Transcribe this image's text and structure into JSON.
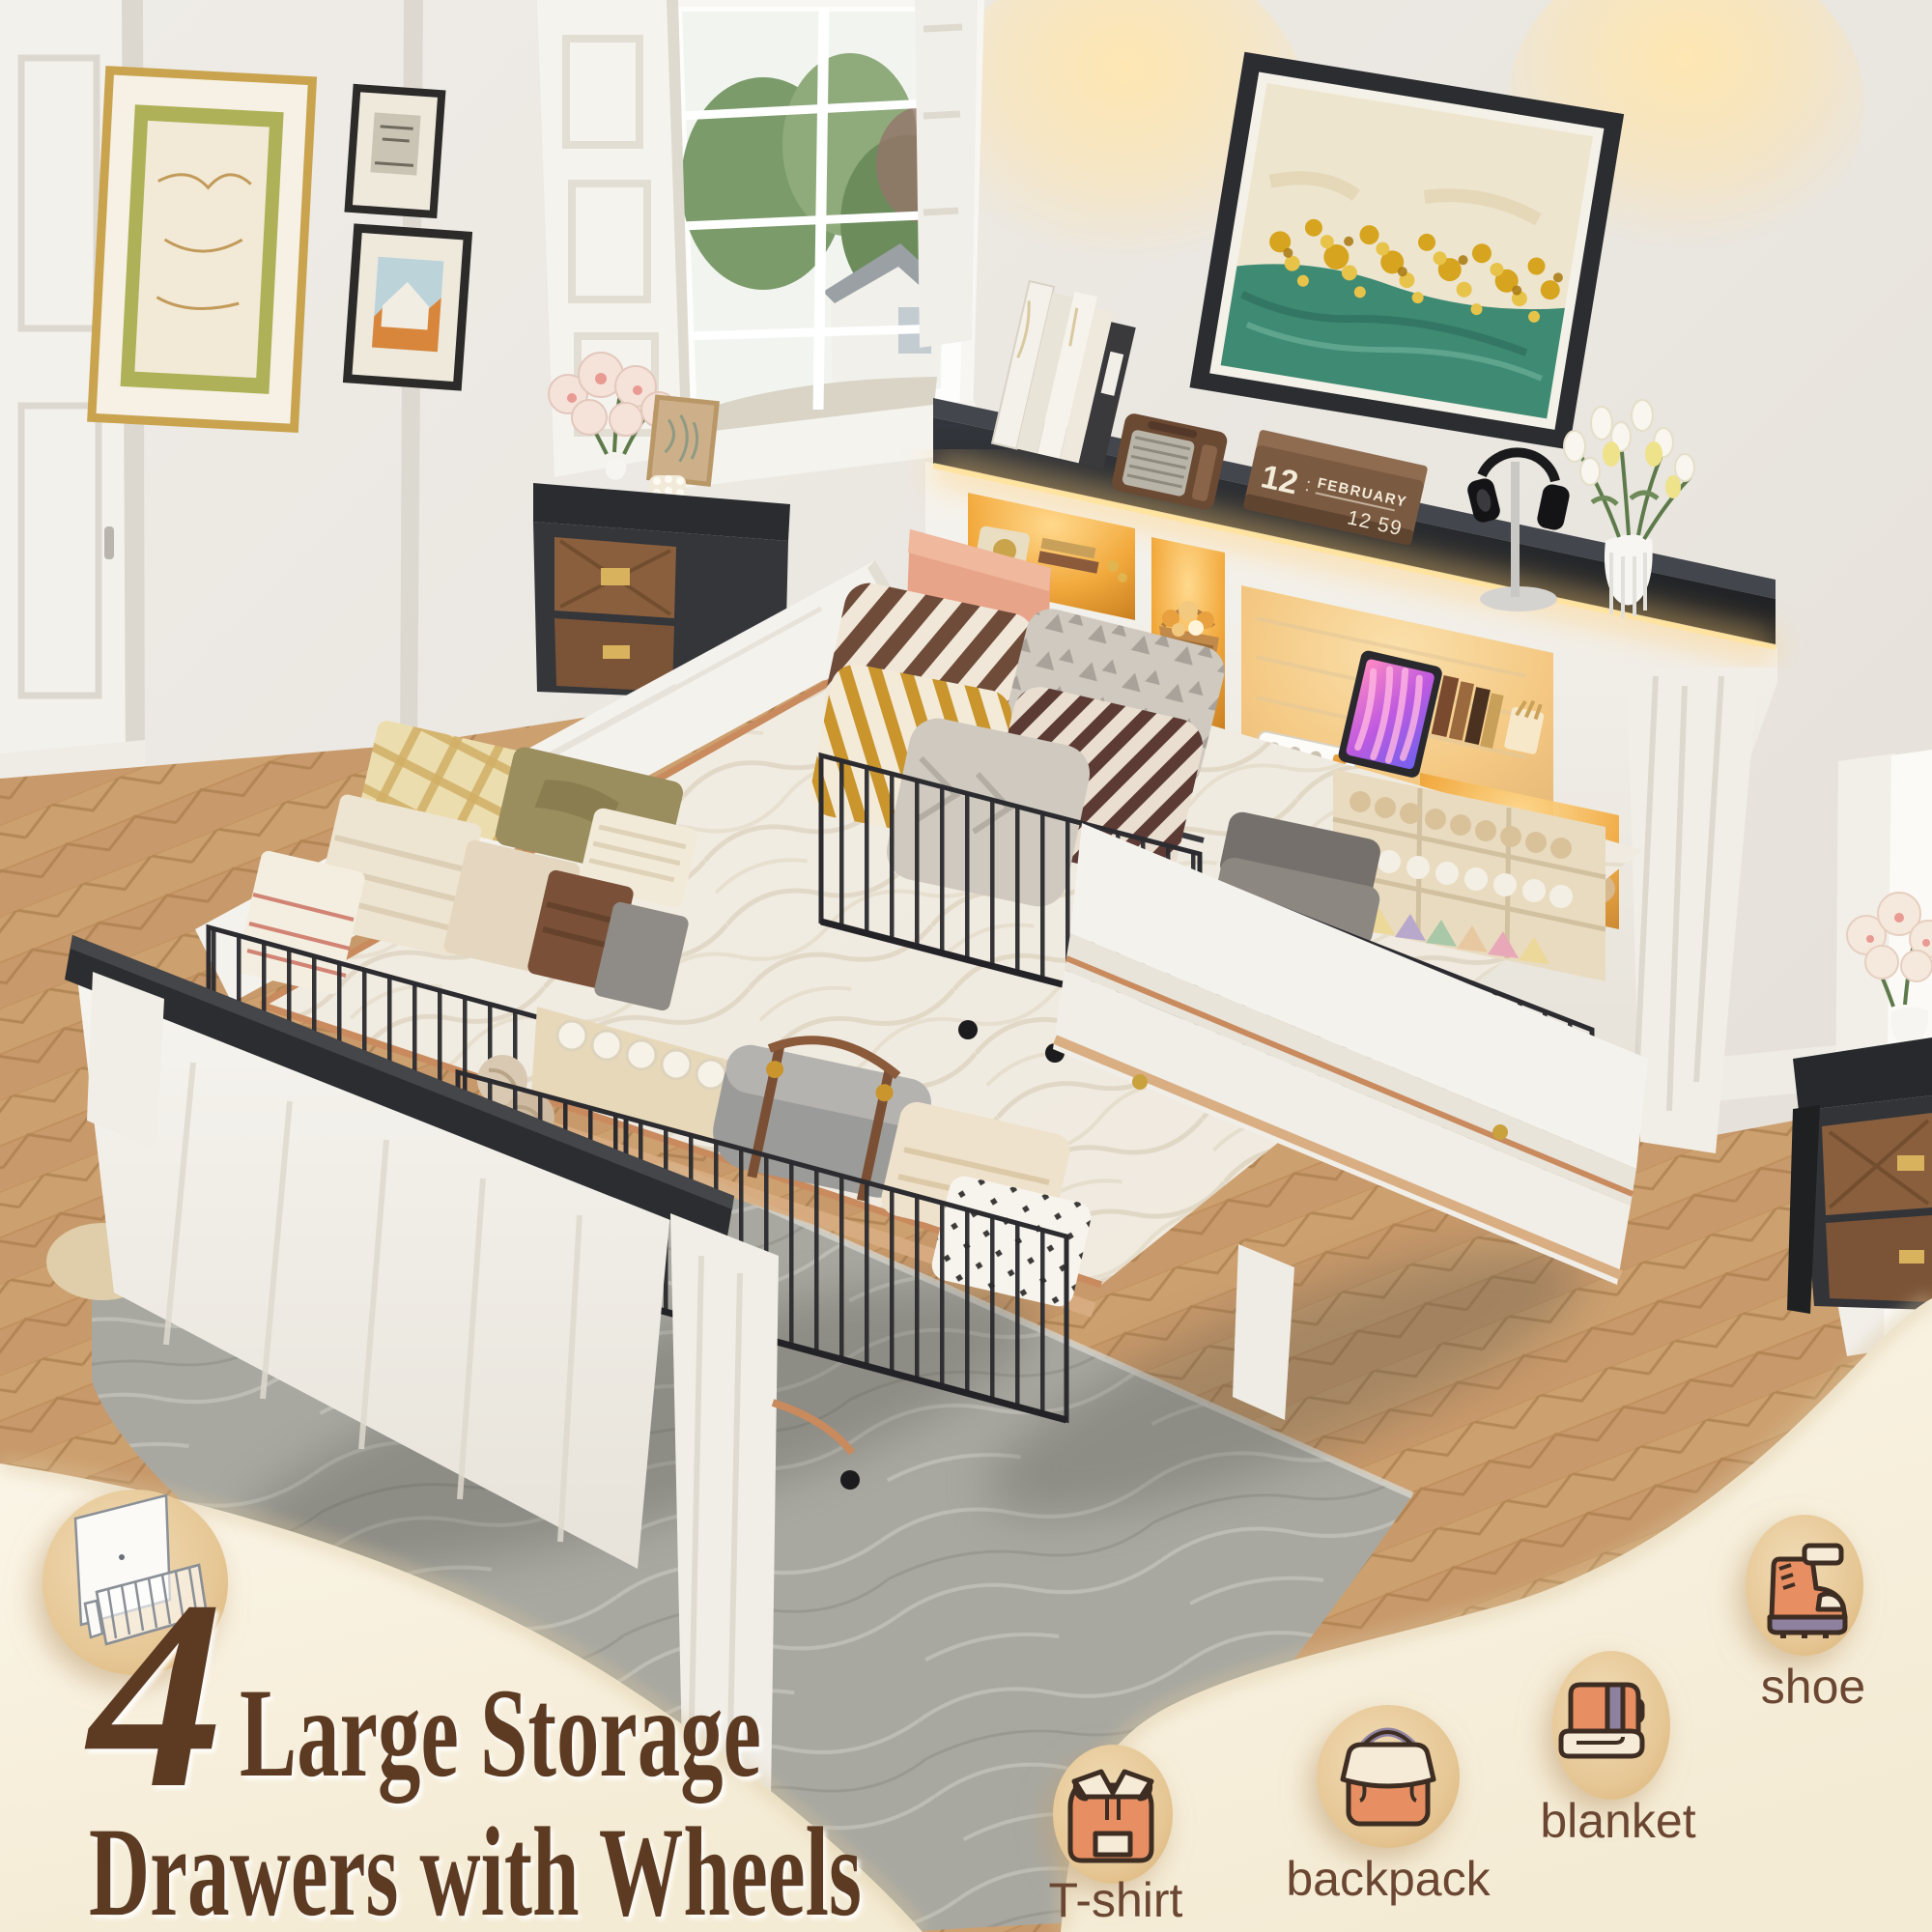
{
  "headline": {
    "number": "4",
    "line1": "Large Storage",
    "line2": "Drawers with Wheels",
    "color": "#5d3a23"
  },
  "feature_icons": [
    {
      "name": "t-shirt-icon",
      "label": "T-shirt"
    },
    {
      "name": "backpack-icon",
      "label": "backpack"
    },
    {
      "name": "blanket-icon",
      "label": "blanket"
    },
    {
      "name": "shoe-icon",
      "label": "shoe"
    }
  ],
  "inset_diagram": {
    "name": "wire-drawer-diagram-icon"
  },
  "scene": {
    "flip_clock": {
      "day": "12",
      "month": "FEBRUARY",
      "time": "12 59"
    },
    "desk_calendar": {
      "month": "NOV",
      "day": "05"
    },
    "palette": {
      "cream_overlay": "#f7f0dd",
      "badge_tan": "#e6c493",
      "icon_orange": "#e78f63",
      "icon_cream": "#f6ebd7",
      "icon_purple": "#8e81a0",
      "outline_brown": "#3e2d22",
      "label_brown": "#6b4733",
      "headline_brown": "#5d3a23",
      "led_amber": "#ffb340",
      "wood_floor": "#c8996a",
      "rug_gray": "#a8a8a1"
    }
  }
}
